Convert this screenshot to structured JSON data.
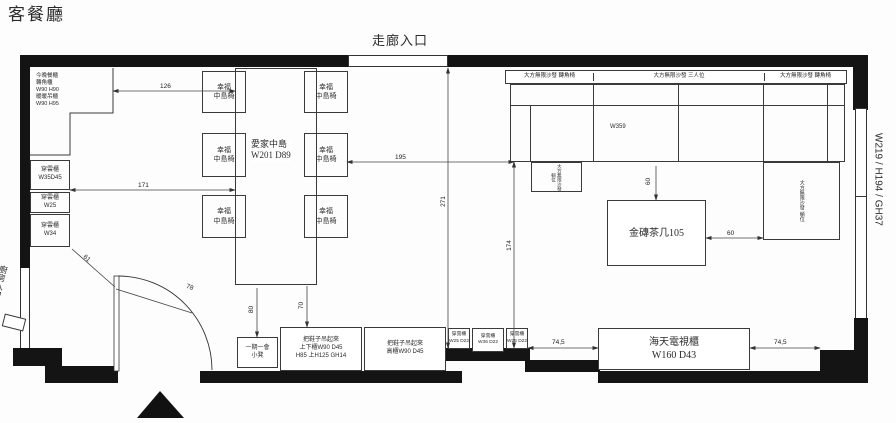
{
  "title": "客餐廳",
  "entrances": {
    "corridor": "走廊入口",
    "kitchen": "廚房入口"
  },
  "window_label": "W219 / H194 / GH37",
  "cabinets": {
    "corner": "今晚餐櫃\n轉角櫃\nW90 H90\n暖暖吊櫃\nW90 H95",
    "left1": "穿雲櫃\nW35D45",
    "left2": "穿雲櫃\nW25",
    "left3": "穿雲櫃\nW34",
    "bottom1": "穿雲櫃\nW25 D22",
    "bottom2": "穿雲櫃\nW36 D22",
    "bottom3": "穿雲櫃\nW25 D22",
    "shoe_duo": "把鞋子吊起來\n上下櫃W90 D45\nH85 上H125 GH14",
    "shoe_tall": "把鞋子吊起來\n高櫃W90 D45",
    "tv": "海天電視櫃\nW160 D43"
  },
  "furniture": {
    "island": "愛家中島\nW201 D89",
    "chair": "幸福\n中島椅",
    "stool": "一期一會\n小凳",
    "coffee_table": "金磚茶几105",
    "sofa_corner_left": "大方無限沙發 轉角椅",
    "sofa_three": "大方無限沙發 三人位",
    "sofa_corner_right": "大方無限沙發 轉角椅",
    "sofa_chaise": "大方無限沙發 躺位",
    "sofa_ottoman": "大方無限沙發 躺位",
    "sofa_width": "W359"
  },
  "dimensions": {
    "d126": "126",
    "d171": "171",
    "d195": "195",
    "d271": "271",
    "d174": "174",
    "d80": "80",
    "d70": "70",
    "d61": "61",
    "d78": "78",
    "d60v": "60",
    "d60h": "60",
    "d745a": "74,5",
    "d745b": "74,5"
  }
}
